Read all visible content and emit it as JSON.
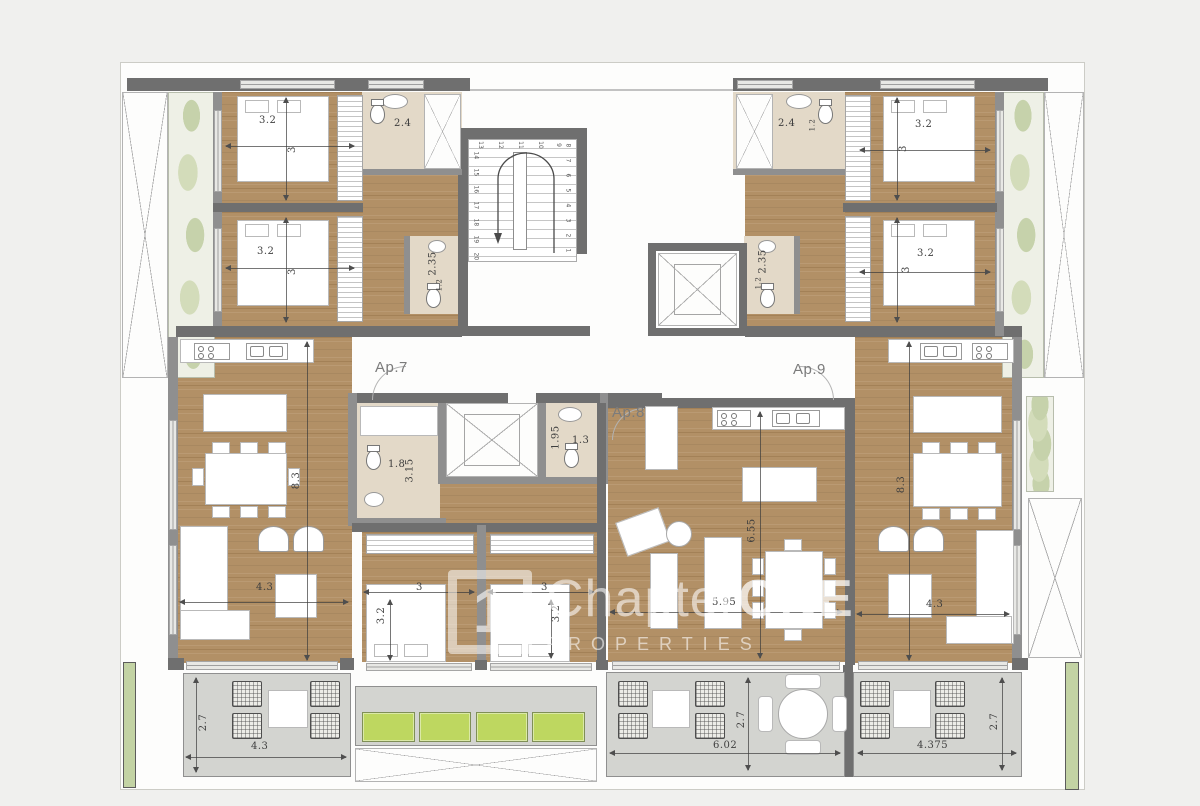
{
  "colors": {
    "wood": "#b29066",
    "wall": "#6f6f6f",
    "terrace": "#d3d4d0",
    "bathroom_floor": "#e3d9c8",
    "planter_green": "#bed760",
    "tree_green": "#c6d2ab",
    "watermark": "#ffffff"
  },
  "apartments": {
    "ap7": "Ap.7",
    "ap8": "Ap.8",
    "ap9": "Ap.9"
  },
  "stairs": {
    "numbers": [
      "1",
      "2",
      "3",
      "4",
      "5",
      "6",
      "7",
      "8",
      "9",
      "10",
      "11",
      "12",
      "13",
      "14",
      "15",
      "16",
      "17",
      "18",
      "19",
      "20"
    ]
  },
  "watermark": {
    "logo": "1",
    "brand": "Chapter",
    "brand_bold": "ONE",
    "subtitle": "PROPERTIES"
  },
  "dimensions": {
    "tl_bed1_w": "3.2",
    "tl_bed1_d": "3",
    "tl_bath": "2.4",
    "tl_bed2_w": "3.2",
    "tl_bed2_d": "3",
    "tl_wc_h": "2.35",
    "tl_wc_w": "1.2",
    "tr_bath": "2.4",
    "tr_bath_d": "1.2",
    "tr_bed1_w": "3.2",
    "tr_bed1_d": "3",
    "tr_wc_h": "2.35",
    "tr_wc_w": "1.2",
    "tr_bed2_w": "3.2",
    "tr_bed2_d": "3",
    "ap7_bath_w": "1.8",
    "ap7_bath_h": "3.15",
    "ap8_bath_h": "1.95",
    "ap8_bath_w": "1.3",
    "ap7_living_h": "8.3",
    "ap7_living_w": "4.3",
    "ap8_living_h": "6.55",
    "ap8_living_w": "5.95",
    "ap9_living_h": "8.3",
    "ap9_living_w": "4.3",
    "bed_a_w": "3",
    "bed_a_d": "3.2",
    "bed_b_w": "3",
    "bed_b_d": "3.2",
    "terrace_left_d": "2.7",
    "terrace_left_w": "4.3",
    "terrace_center_d": "2.7",
    "terrace_center_w": "6.02",
    "terrace_right_d": "2.7",
    "terrace_right_w": "4.375"
  }
}
